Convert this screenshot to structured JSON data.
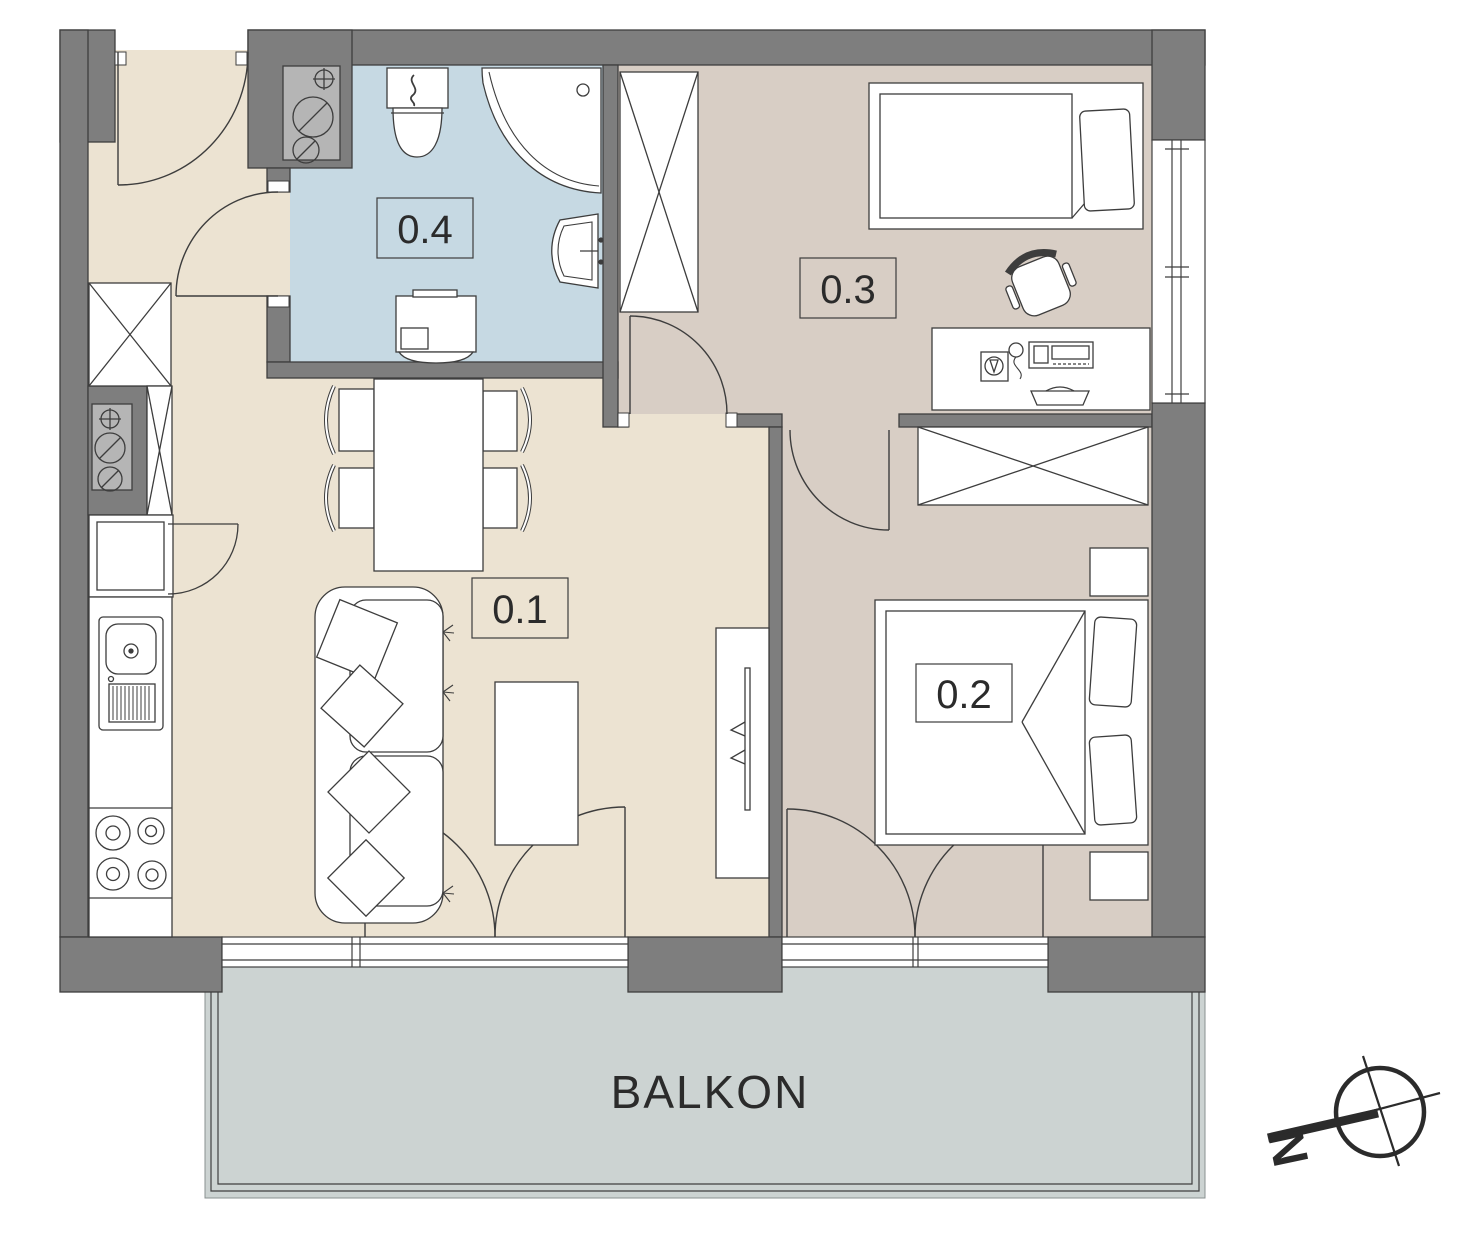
{
  "plan": {
    "rooms": [
      {
        "id": "room-0-1",
        "label": "0.1",
        "floor_color": "#ece3d2"
      },
      {
        "id": "room-0-2",
        "label": "0.2",
        "floor_color": "#d8cec5"
      },
      {
        "id": "room-0-3",
        "label": "0.3",
        "floor_color": "#d8cec5"
      },
      {
        "id": "room-0-4",
        "label": "0.4",
        "floor_color": "#c6d9e3"
      }
    ],
    "balcony_label": "BALKON",
    "compass_letter": "N",
    "colors": {
      "wall": "#7e7e7e",
      "wall_outline": "#3f3f3f",
      "line": "#3d3d3d",
      "text": "#2b2b2b",
      "furniture_fill": "#ffffff",
      "shaft_fill": "#b5b5b5",
      "balcony_floor": "#ccd3d2",
      "living_floor": "#ece3d2",
      "bedroom_floor": "#d8cec5",
      "bath_floor": "#c6d9e3"
    },
    "icons": [
      "entry-door-icon",
      "wardrobe-icon",
      "installation-shaft-icon",
      "refrigerator-icon",
      "kitchen-sink-icon",
      "stove-icon",
      "dining-table-icon",
      "chair-icon",
      "sofa-icon",
      "coffee-table-icon",
      "tv-lowboard-icon",
      "toilet-icon",
      "corner-bathtub-icon",
      "washbasin-icon",
      "washing-machine-icon",
      "single-bed-icon",
      "desk-icon",
      "office-chair-icon",
      "double-bed-icon",
      "nightstand-icon",
      "window-icon",
      "balcony-door-icon",
      "north-compass-icon"
    ]
  }
}
